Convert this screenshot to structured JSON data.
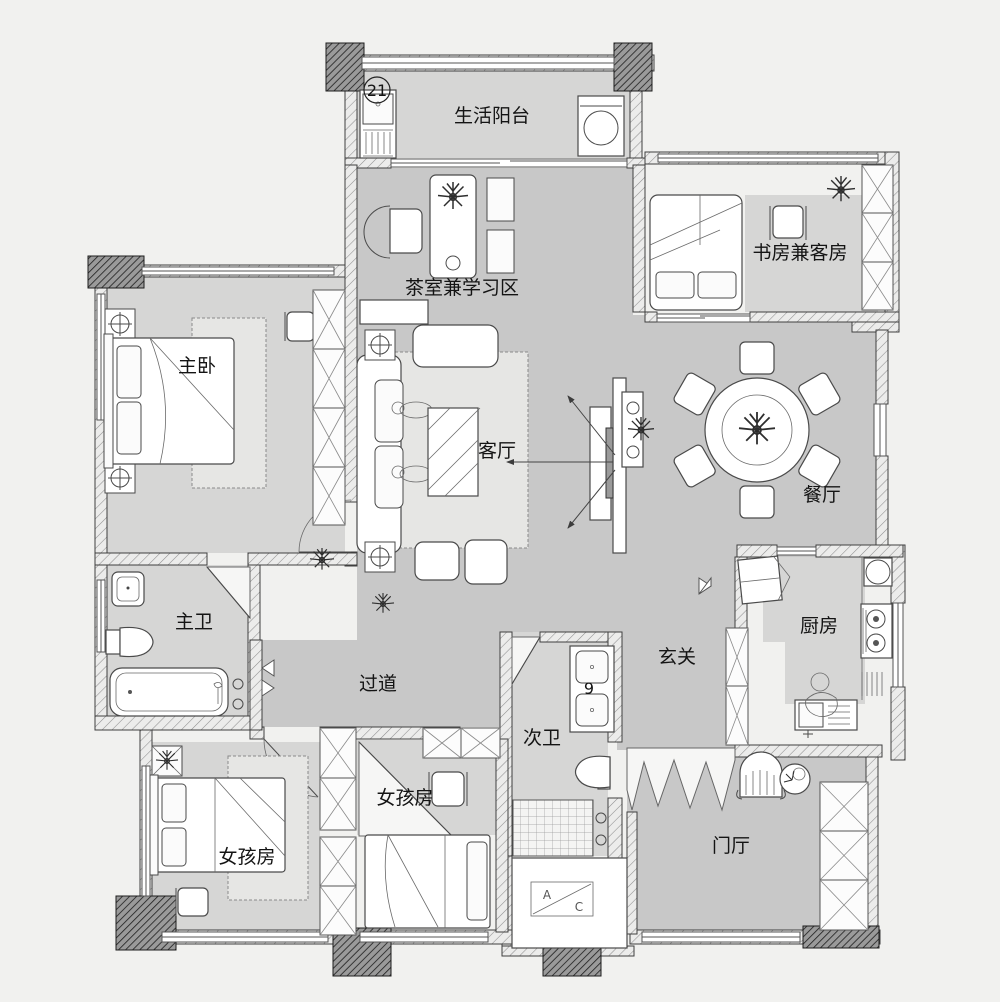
{
  "title": "apartment-floor-plan",
  "colors": {
    "bg": "#f1f1ef",
    "floor-public": "#c8c8c8",
    "floor-room": "#d6d6d5",
    "wall-line": "#3f3f3f",
    "furn-line": "#4a4a4a",
    "label": "#141414"
  },
  "rooms": [
    {
      "name": "life-balcony",
      "label": "生活阳台"
    },
    {
      "name": "study-guest-room",
      "label": "书房兼客房"
    },
    {
      "name": "tea-study-area",
      "label": "茶室兼学习区"
    },
    {
      "name": "master-bedroom",
      "label": "主卧"
    },
    {
      "name": "living-room",
      "label": "客厅"
    },
    {
      "name": "dining-room",
      "label": "餐厅"
    },
    {
      "name": "master-bathroom",
      "label": "主卫"
    },
    {
      "name": "hallway",
      "label": "过道"
    },
    {
      "name": "entry",
      "label": "玄关"
    },
    {
      "name": "kitchen",
      "label": "厨房"
    },
    {
      "name": "second-bathroom",
      "label": "次卫"
    },
    {
      "name": "girls-room-west",
      "label": "女孩房"
    },
    {
      "name": "girls-room-middle",
      "label": "女孩房"
    },
    {
      "name": "entrance-hall",
      "label": "门厅"
    }
  ],
  "annotations": {
    "balcony_dim": "21",
    "vanity_dim": "9",
    "ac_box_a": "A",
    "ac_box_c": "C"
  }
}
